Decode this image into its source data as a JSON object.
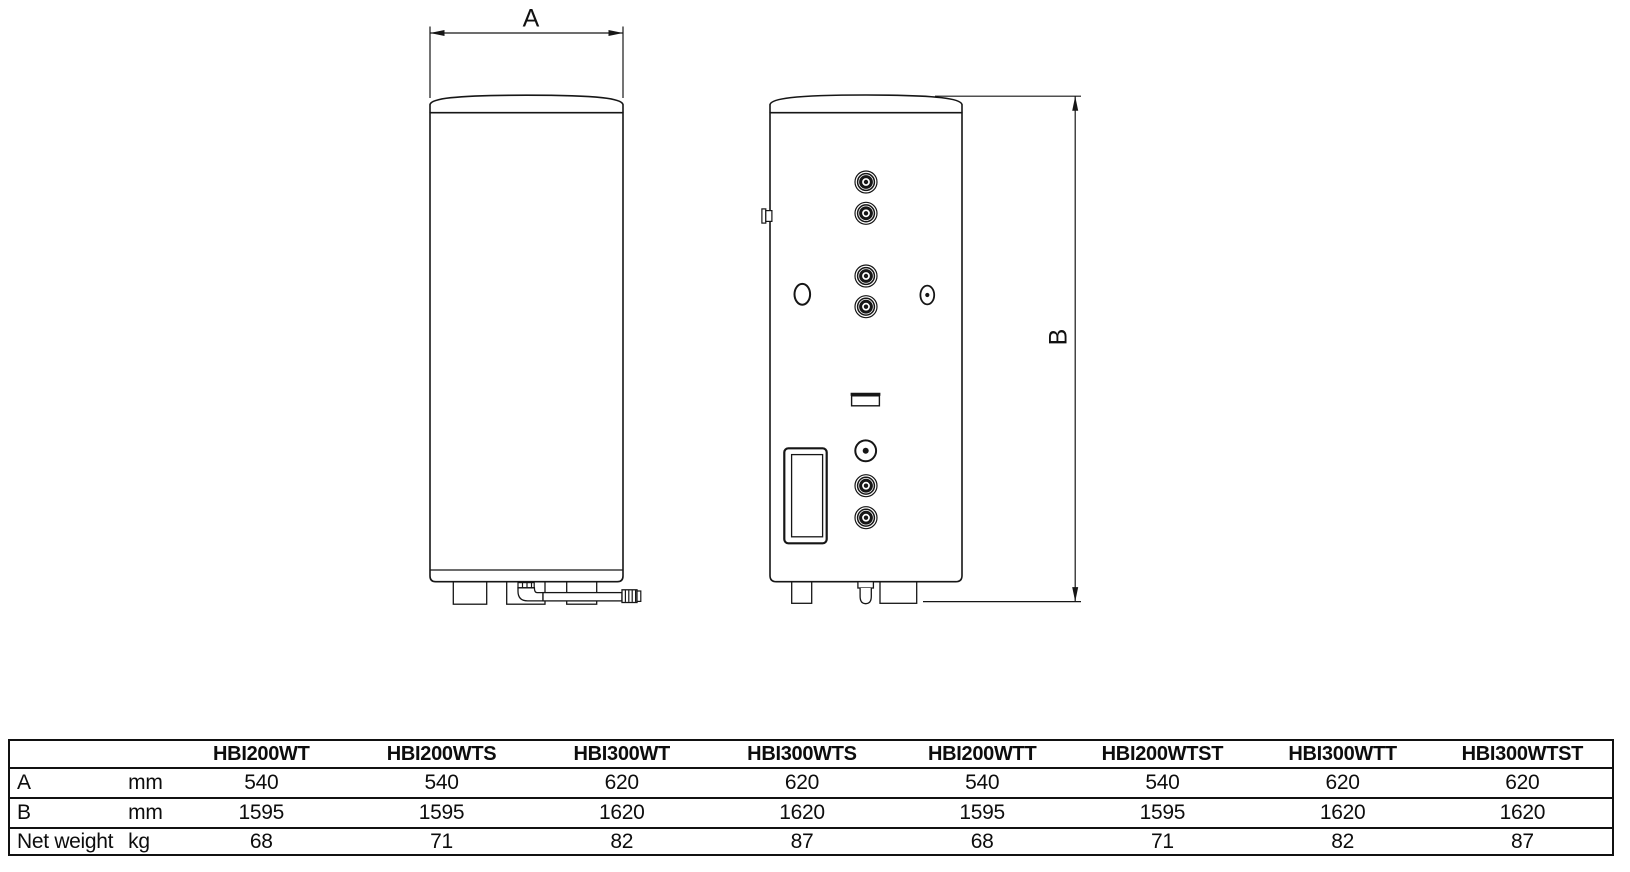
{
  "drawing": {
    "dim_a_label": "A",
    "dim_b_label": "B"
  },
  "table": {
    "corner_label": "",
    "unit_header": "",
    "columns": [
      "HBI200WT",
      "HBI200WTS",
      "HBI300WT",
      "HBI300WTS",
      "HBI200WTT",
      "HBI200WTST",
      "HBI300WTT",
      "HBI300WTST"
    ],
    "rows": [
      {
        "label": "A",
        "unit": "mm",
        "values": [
          "540",
          "540",
          "620",
          "620",
          "540",
          "540",
          "620",
          "620"
        ]
      },
      {
        "label": "B",
        "unit": "mm",
        "values": [
          "1595",
          "1595",
          "1620",
          "1620",
          "1595",
          "1595",
          "1620",
          "1620"
        ]
      },
      {
        "label": "Net weight",
        "unit": "kg",
        "values": [
          "68",
          "71",
          "82",
          "87",
          "68",
          "71",
          "82",
          "87"
        ]
      }
    ]
  },
  "colors": {
    "line": "#161616",
    "text": "#111111",
    "background": "#ffffff"
  }
}
